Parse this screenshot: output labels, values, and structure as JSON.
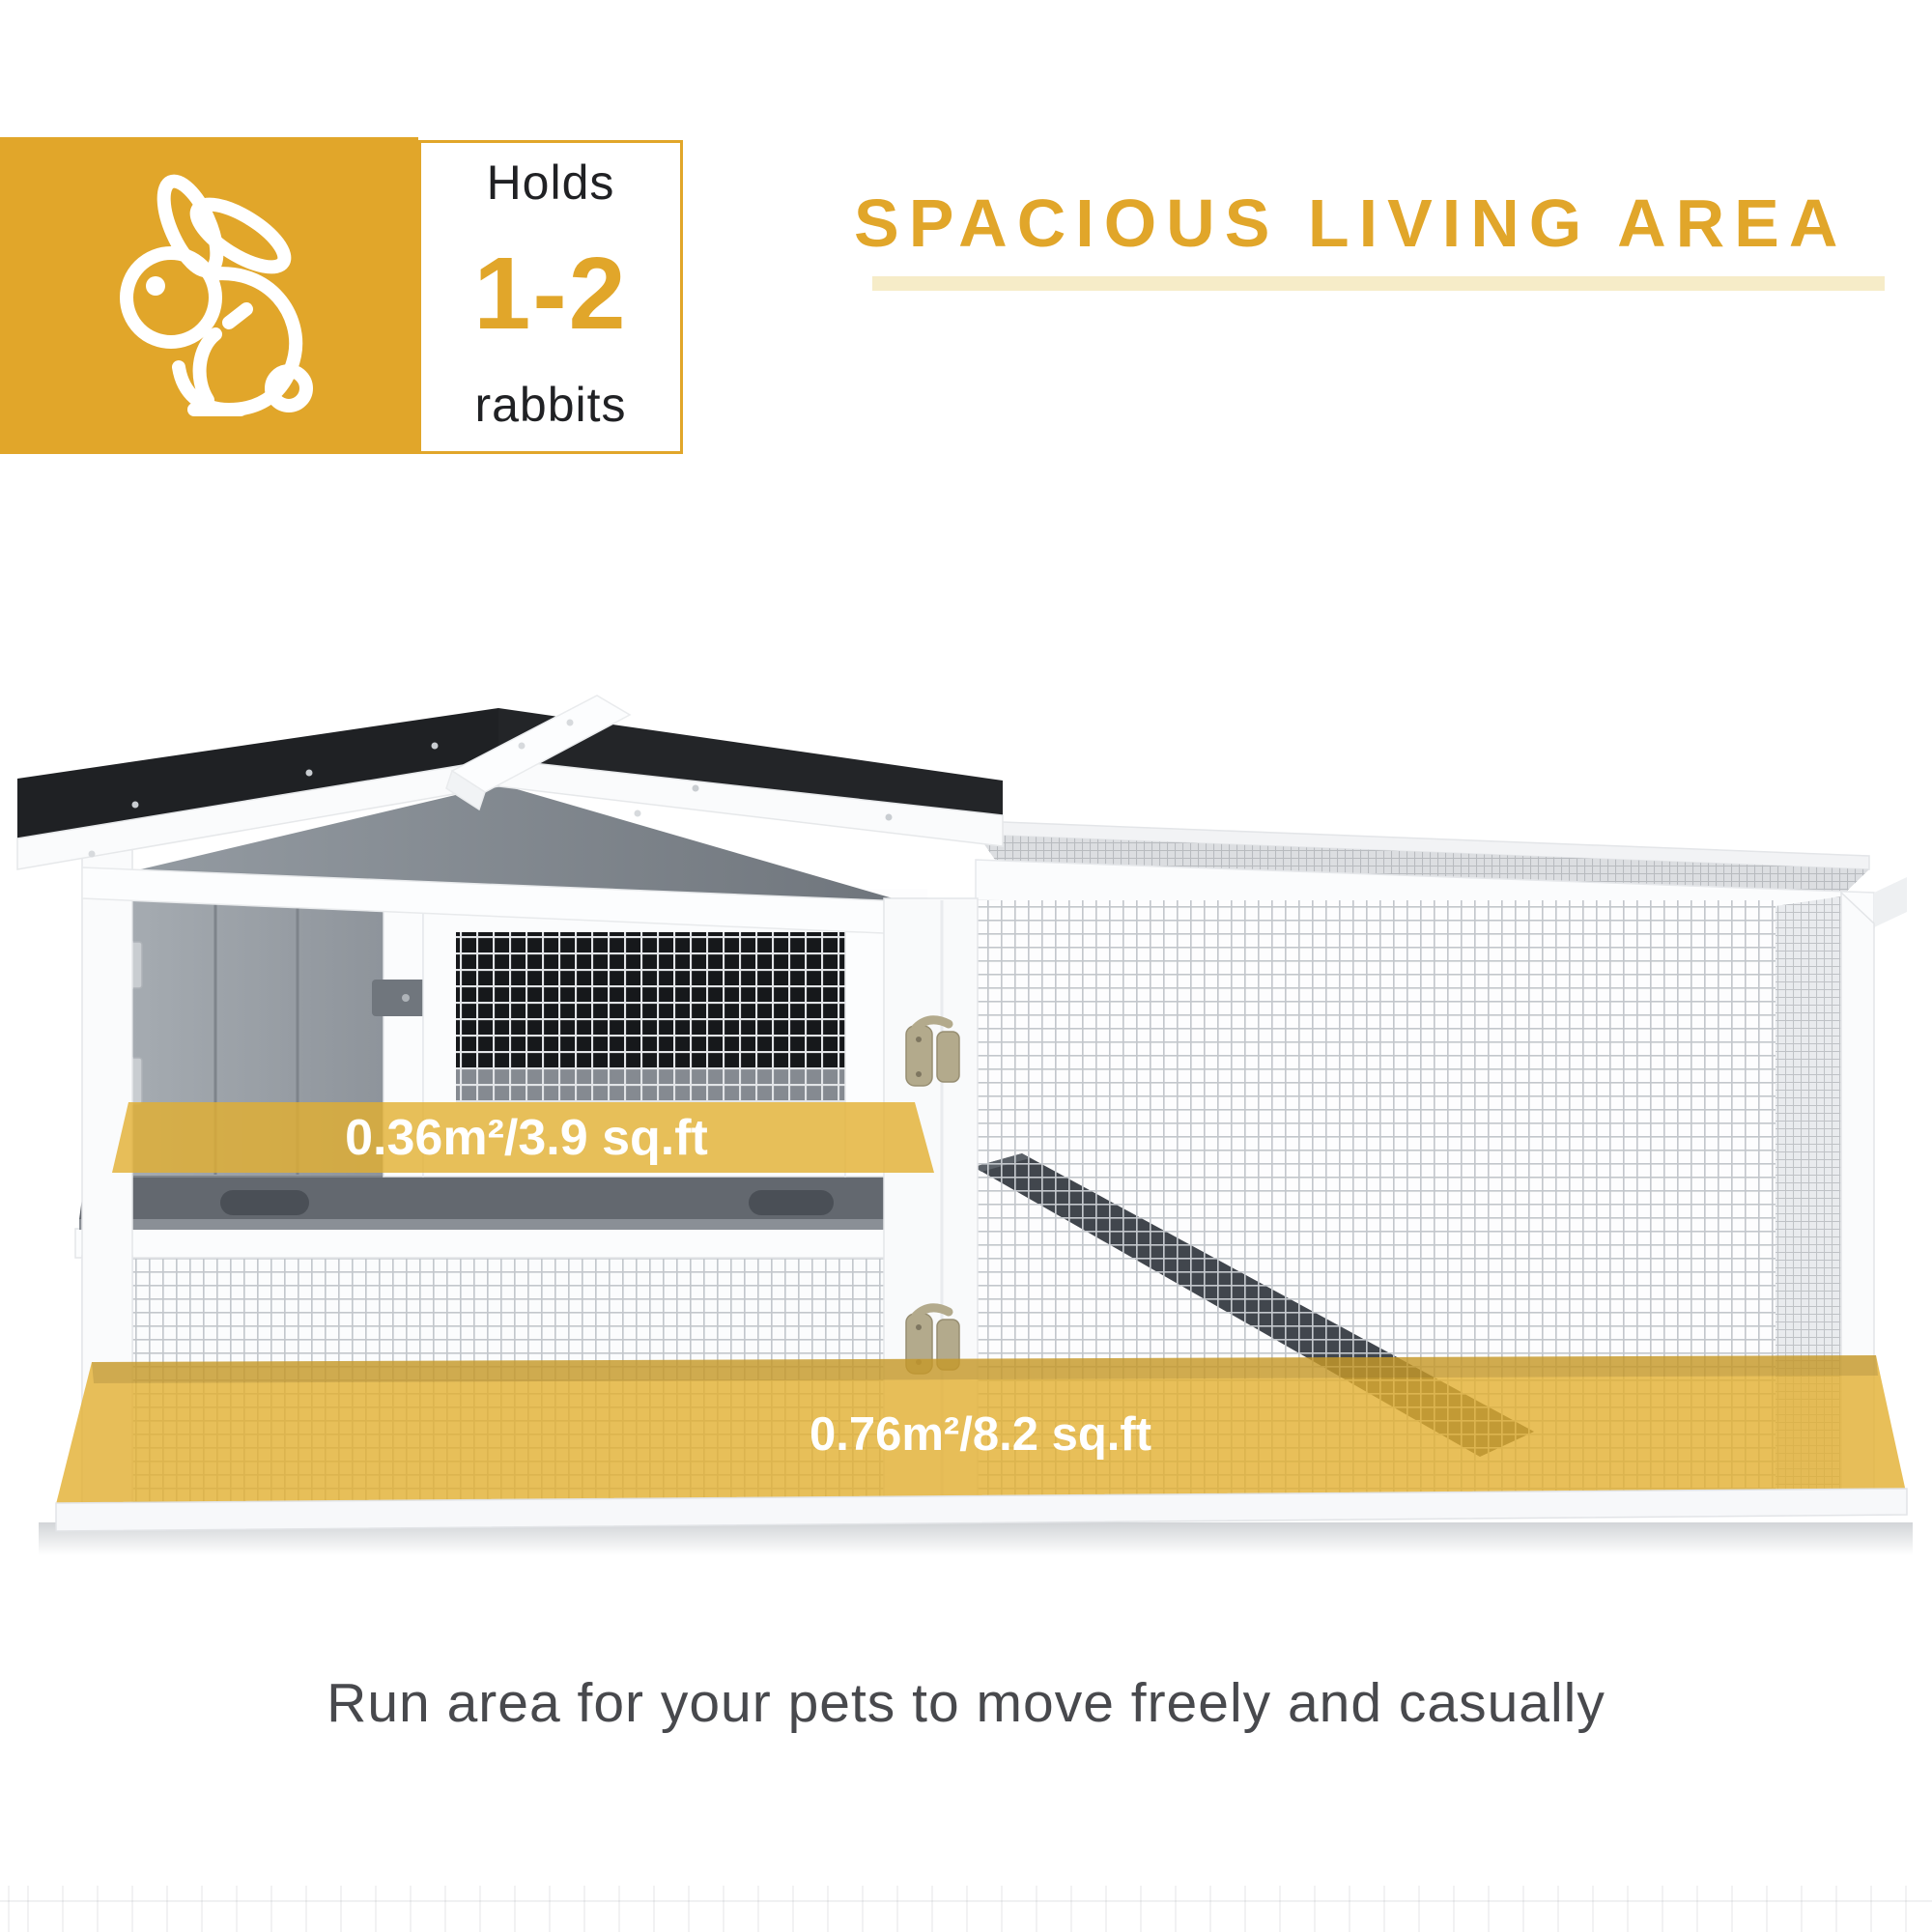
{
  "badge": {
    "holds_label": "Holds",
    "count": "1-2",
    "animal_label": "rabbits"
  },
  "heading": {
    "title": "SPACIOUS LIVING AREA"
  },
  "hutch": {
    "upper_area_label": "0.36m²/3.9 sq.ft",
    "run_area_label": "0.76m²/8.2 sq.ft"
  },
  "caption": {
    "text": "Run area for your pets to move freely and casually"
  },
  "colors": {
    "brand_gold": "#E1A62A",
    "highlight_yellow": "#E2AF2F",
    "underline_pale": "#F6ECC8",
    "caption_gray": "#48494D",
    "roof_black": "#212326",
    "wood_gray": "#99A0A7",
    "tray_gray": "#63686F"
  }
}
